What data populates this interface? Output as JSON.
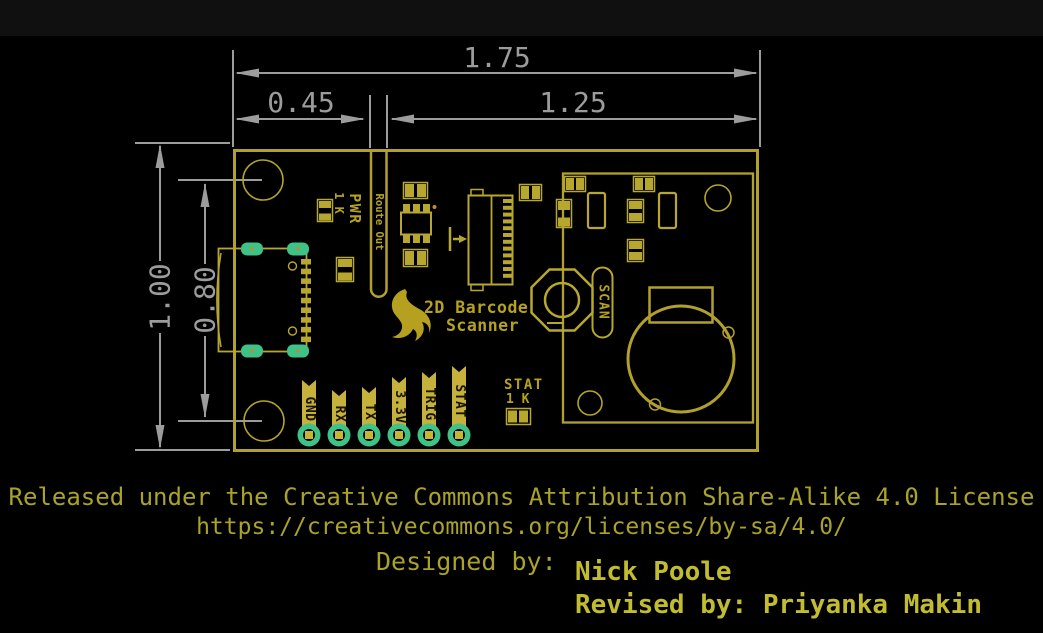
{
  "drawing": {
    "dimensions": {
      "board_width_in": "1.75",
      "usb_section_width_in": "0.45",
      "module_section_width_in": "1.25",
      "board_height_in": "1.00",
      "mount_hole_spacing_in": "0.80"
    },
    "silkscreen": {
      "logo_line1": "2D Barcode",
      "logo_line2": "Scanner",
      "route_out_label": "Route Out",
      "pwr_label": "PWR",
      "pwr_resistor_value": "1 K",
      "scan_button_label": "SCAN",
      "stat_label": "STAT",
      "stat_resistor_value": "1 K",
      "pins": [
        {
          "label": "GND"
        },
        {
          "label": "RX"
        },
        {
          "label": "TX"
        },
        {
          "label": "3.3V"
        },
        {
          "label": "TRIG"
        },
        {
          "label": "STAT"
        }
      ]
    },
    "colors": {
      "background": "#000000",
      "top_bar": "#101010",
      "board_outline_yellow": "#b2a02c",
      "silk_yellow": "#b8a72e",
      "flag_yellow": "#c6b13d",
      "pad_green": "#3ec287",
      "drill_yellow": "#c8b531",
      "dimension_gray": "#9c9c9c",
      "footer_olive": "#a9a22b",
      "credit_yellow": "#c2bc31"
    }
  },
  "footer": {
    "license_line1": "Released under the Creative Commons Attribution Share-Alike 4.0 License",
    "license_line2": "https://creativecommons.org/licenses/by-sa/4.0/",
    "designed_by_label": "Designed by:",
    "designer_name": "Nick Poole",
    "revised_by": "Revised by: Priyanka Makin"
  }
}
